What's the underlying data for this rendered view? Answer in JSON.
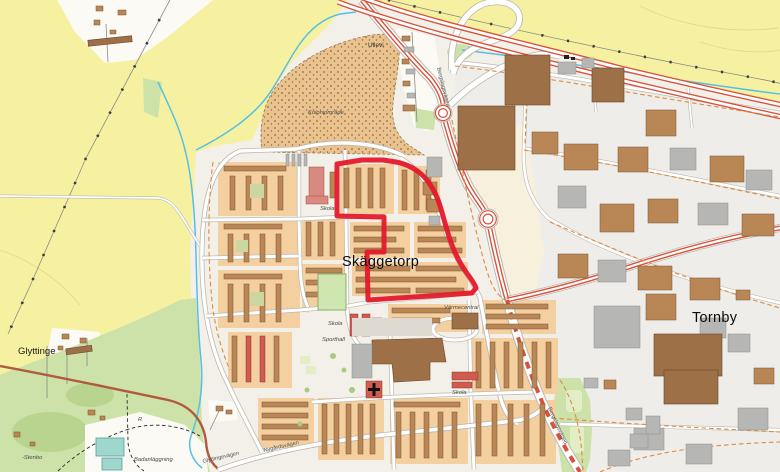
{
  "map": {
    "labels": {
      "ullevi": "Ullevi",
      "allotment": "Koloniområde",
      "skaggetorp": "Skäggetorp",
      "tornby": "Tornby",
      "glyttinge": "Glyttinge",
      "stenbo": "-Stenbo",
      "badanlaggning": "Badanläggning",
      "glyttingevagen": "Glyttingevägen",
      "nygardsvagen": "Nygårdsvägen",
      "skola": "Skola",
      "sporthall": "Sporthall",
      "varmecentral": "Värmecentral",
      "bergslagsvagen": "Bergslagsvägen",
      "ruin": "R"
    },
    "highlight": {
      "meaning": "red boundary outlining central Skäggetorp housing blocks",
      "color": "#e5182b"
    },
    "colors": {
      "field_yellow": "#f6f1a1",
      "urban_white": "#f3f0e9",
      "industrial_gray": "#eeedea",
      "green_area": "#cde2a9",
      "water_blue": "#56c0e4",
      "motorway_red": "#d8523c",
      "block_orange": "#f4d0a0",
      "building_brown": "#b98756",
      "building_dark": "#9e7047",
      "building_gray": "#b6b6b4",
      "school_red": "#cf5c4e",
      "allotment_tan": "#eac28e",
      "path_orange": "#e08a3c"
    }
  }
}
